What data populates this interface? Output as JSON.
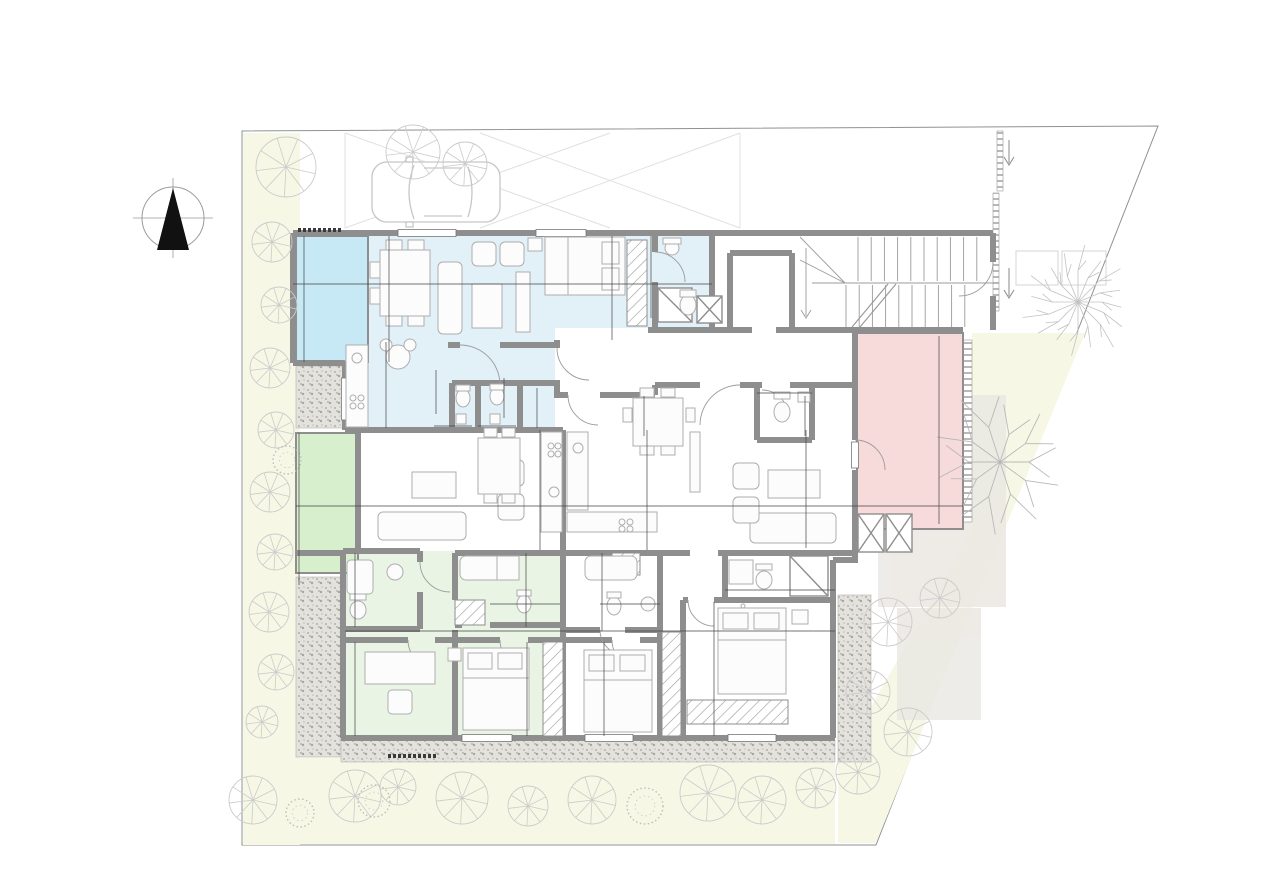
{
  "plan_title": "Ground floor apartment plan",
  "north_indicator": {
    "label": "B"
  },
  "unit_markers": [
    {
      "id": "103",
      "x": 581,
      "y": 365,
      "dir": "left",
      "ax": 566,
      "ay": 362
    },
    {
      "id": "102",
      "x": 591,
      "y": 380,
      "dir": "down",
      "ax": 591,
      "ay": 390
    },
    {
      "id": "101",
      "x": 747,
      "y": 372,
      "dir": "down",
      "ax": 747,
      "ay": 386
    }
  ],
  "verandas": [
    {
      "name": "COVERED VERANDA",
      "line1": "COVERED",
      "line2": "VERANDA",
      "x": 326,
      "y": 316,
      "fill": "#c7e8f5",
      "text_color": "#2d5a70"
    },
    {
      "name": "COVERED VERANDA",
      "line1": "COVERED",
      "line2": "VERANDA",
      "x": 327,
      "y": 462,
      "fill": "#d8efcd",
      "text_color": "#2f5d33"
    },
    {
      "name": "COVERED VERANDA",
      "line1": "COVERED",
      "line2": "VERANDA",
      "x": 908,
      "y": 458,
      "fill": "#f7dbda",
      "text_color": "#6b4848"
    }
  ],
  "annotations": [
    {
      "t": "W",
      "x": 505,
      "y": 574
    },
    {
      "t": "W",
      "x": 737,
      "y": 587
    },
    {
      "t": "W",
      "x": 357,
      "y": 370
    }
  ],
  "dimensions": [
    {
      "t": "1.95",
      "x": 325,
      "y": 281,
      "v": false
    },
    {
      "t": "4.70",
      "x": 487,
      "y": 281,
      "v": false
    },
    {
      "t": "3.00",
      "x": 577,
      "y": 281,
      "v": false
    },
    {
      "t": "0.60",
      "x": 637,
      "y": 281,
      "v": false
    },
    {
      "t": "1.75",
      "x": 681,
      "y": 281,
      "v": false
    },
    {
      "t": "3.95",
      "x": 301,
      "y": 298,
      "v": true
    },
    {
      "t": "3.40",
      "x": 386,
      "y": 297,
      "v": true
    },
    {
      "t": "3.00",
      "x": 609,
      "y": 272,
      "v": true
    },
    {
      "t": "2.50",
      "x": 648,
      "y": 272,
      "v": true
    },
    {
      "t": "0.70",
      "x": 383,
      "y": 357,
      "v": true
    },
    {
      "t": "1.05",
      "x": 383,
      "y": 393,
      "v": true
    },
    {
      "t": "0.60",
      "x": 383,
      "y": 419,
      "v": true
    },
    {
      "t": "1.40",
      "x": 433,
      "y": 392,
      "v": true
    },
    {
      "t": "1.00",
      "x": 453,
      "y": 423,
      "v": false
    },
    {
      "t": "1.10",
      "x": 496,
      "y": 423,
      "v": false
    },
    {
      "t": "1.40",
      "x": 501,
      "y": 397,
      "v": true
    },
    {
      "t": "1.15",
      "x": 537,
      "y": 408,
      "v": true
    },
    {
      "t": "1.40",
      "x": 641,
      "y": 413,
      "v": true
    },
    {
      "t": "1.35",
      "x": 782,
      "y": 390,
      "v": false
    },
    {
      "t": "1.15",
      "x": 802,
      "y": 413,
      "v": true
    },
    {
      "t": "1.95",
      "x": 327,
      "y": 503,
      "v": false
    },
    {
      "t": "3.75",
      "x": 429,
      "y": 503,
      "v": false
    },
    {
      "t": "1.90",
      "x": 522,
      "y": 503,
      "v": false
    },
    {
      "t": "0.60",
      "x": 563,
      "y": 503,
      "v": false
    },
    {
      "t": "0.60",
      "x": 592,
      "y": 503,
      "v": false
    },
    {
      "t": "1.80",
      "x": 631,
      "y": 503,
      "v": false
    },
    {
      "t": "0.70",
      "x": 673,
      "y": 503,
      "v": false
    },
    {
      "t": "4.90",
      "x": 766,
      "y": 503,
      "v": false
    },
    {
      "t": "3.10",
      "x": 907,
      "y": 503,
      "v": false
    },
    {
      "t": "4.15",
      "x": 297,
      "y": 490,
      "v": true
    },
    {
      "t": "3.30",
      "x": 387,
      "y": 487,
      "v": true
    },
    {
      "t": "2.80",
      "x": 538,
      "y": 472,
      "v": true
    },
    {
      "t": "2.55",
      "x": 645,
      "y": 481,
      "v": true
    },
    {
      "t": "3.55",
      "x": 803,
      "y": 487,
      "v": true
    },
    {
      "t": "6.15",
      "x": 936,
      "y": 429,
      "v": true
    },
    {
      "t": "0.60",
      "x": 538,
      "y": 532,
      "v": true
    },
    {
      "t": "0.60",
      "x": 645,
      "y": 532,
      "v": true
    },
    {
      "t": "2.10",
      "x": 353,
      "y": 588,
      "v": true
    },
    {
      "t": "2.05",
      "x": 524,
      "y": 586,
      "v": true
    },
    {
      "t": "2.05",
      "x": 600,
      "y": 583,
      "v": true
    },
    {
      "t": "1.65",
      "x": 544,
      "y": 600,
      "v": false
    },
    {
      "t": "1.80",
      "x": 622,
      "y": 601,
      "v": false
    },
    {
      "t": "2.85",
      "x": 789,
      "y": 587,
      "v": false
    },
    {
      "t": "1.30",
      "x": 801,
      "y": 577,
      "v": true
    },
    {
      "t": "3.15",
      "x": 402,
      "y": 628,
      "v": false
    },
    {
      "t": "3.00",
      "x": 503,
      "y": 628,
      "v": false
    },
    {
      "t": "0.60",
      "x": 564,
      "y": 628,
      "v": false
    },
    {
      "t": "3.00",
      "x": 631,
      "y": 628,
      "v": false
    },
    {
      "t": "3.00",
      "x": 733,
      "y": 628,
      "v": false
    },
    {
      "t": "2.90",
      "x": 352,
      "y": 670,
      "v": true
    },
    {
      "t": "3.00",
      "x": 524,
      "y": 670,
      "v": true
    },
    {
      "t": "3.00",
      "x": 601,
      "y": 672,
      "v": true
    },
    {
      "t": "3.00",
      "x": 711,
      "y": 655,
      "v": true
    },
    {
      "t": "0.60",
      "x": 711,
      "y": 707,
      "v": true
    }
  ],
  "colors": {
    "wall": "#8e8e8e",
    "unit103_fill": "#e2f0f8",
    "veranda_blue": "#c7e8f5",
    "veranda_green": "#d8efcd",
    "veranda_pink": "#f7dbda",
    "unit102_fill": "#eaf4e5",
    "lawn": "#f6f8e5",
    "gravel_base": "#e3e1dc",
    "tree_stroke": "#c9c9c9",
    "dim_text": "#111111"
  }
}
